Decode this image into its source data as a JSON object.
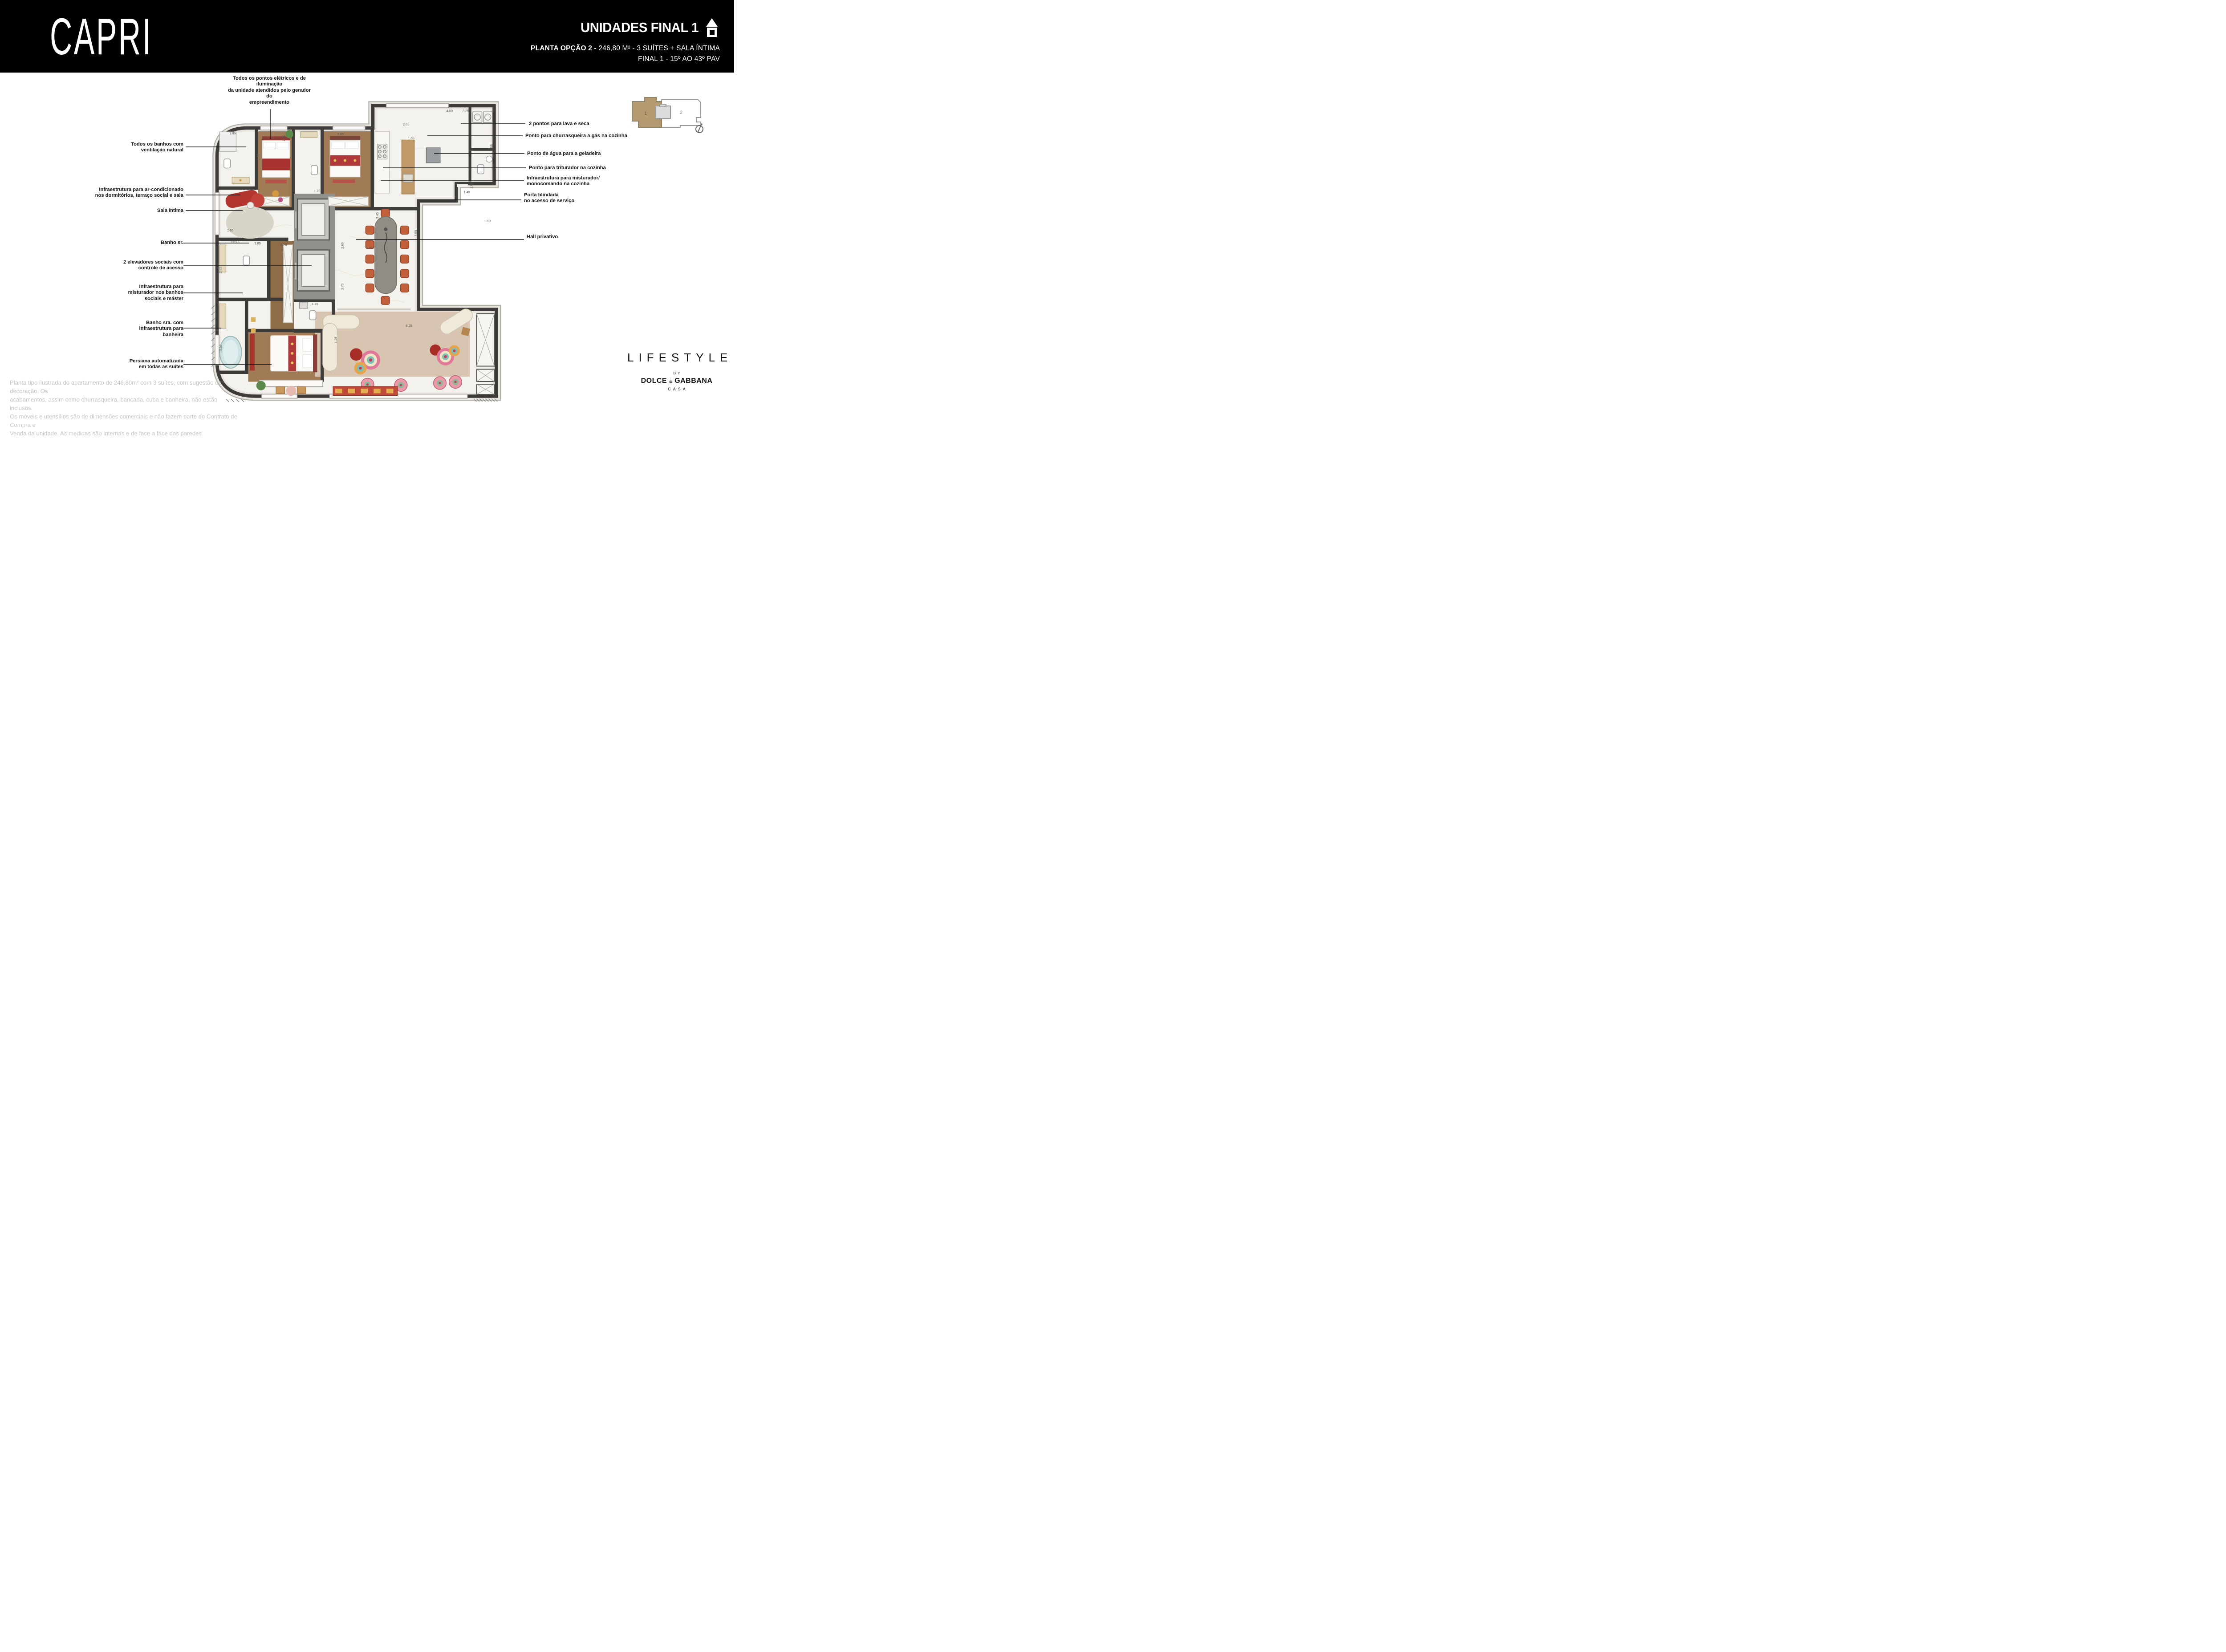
{
  "header": {
    "brand": "CAPRI",
    "units_title": "UNIDADES FINAL 1",
    "plan_option_bold": "PLANTA OPÇÃO 2 - ",
    "plan_option_rest": "246,80 M² - 3 SUÍTES + SALA ÍNTIMA",
    "floors_line": "FINAL 1 - 15º AO 43º PAV"
  },
  "key_plan": {
    "unit_1": "1",
    "unit_2": "2"
  },
  "callouts_left": [
    {
      "label": "Todos os pontos elétricos e de\niluminação\nda unidade atendidos pelo gerador\ndo\nempreendimento"
    },
    {
      "label": "Todos os banhos com\nventilação natural"
    },
    {
      "label": "Infraestrutura para ar-condicionado\nnos dormitórios, terraço social e sala"
    },
    {
      "label": "Sala íntima"
    },
    {
      "label": "Banho sr."
    },
    {
      "label": "2 elevadores sociais com\ncontrole de acesso"
    },
    {
      "label": "Infraestrutura para\nmisturador nos banhos\nsociais e máster"
    },
    {
      "label": "Banho sra. com\ninfraestrutura para\nbanheira"
    },
    {
      "label": "Persiana automatizada\nem todas as suítes"
    }
  ],
  "callouts_right": [
    {
      "label": "2 pontos para lava e seca"
    },
    {
      "label": "Ponto para churrasqueira a gás na cozinha"
    },
    {
      "label": "Ponto de água para a geladeira"
    },
    {
      "label": "Ponto para triturador na cozinha"
    },
    {
      "label": "Infraestrutura para misturador/\nmonocomando na cozinha"
    },
    {
      "label": "Porta blindada\nno acesso de serviço"
    },
    {
      "label": "Hall privativo"
    }
  ],
  "plan": {
    "dims": [
      {
        "t": "1.85"
      },
      {
        "t": "2.35"
      },
      {
        "t": "2.40"
      },
      {
        "t": "2.80"
      },
      {
        "t": "1.70"
      },
      {
        "t": "1.65"
      },
      {
        "t": "12.25"
      },
      {
        "t": "4.00"
      },
      {
        "t": "2.25"
      },
      {
        "t": "2.05"
      },
      {
        "t": "1.55"
      },
      {
        "t": "3.45"
      },
      {
        "t": "1.45"
      },
      {
        "t": "1.10"
      },
      {
        "t": "1.95"
      },
      {
        "t": "2.55"
      },
      {
        "t": "4.20"
      },
      {
        "t": "1.50"
      },
      {
        "t": "3.70"
      },
      {
        "t": "2.60"
      },
      {
        "t": "1.75"
      },
      {
        "t": "1.25"
      },
      {
        "t": "2.45"
      },
      {
        "t": "8.25"
      },
      {
        "t": "7.55"
      },
      {
        "t": "1.85"
      },
      {
        "t": "3.50"
      }
    ]
  },
  "disclaimer": {
    "text": "Planta tipo ilustrada do apartamento de 246,80m² com 3 suítes, com sugestão de decoração. Os\nacabamentos, assim como churrasqueira, bancada, cuba e banheira, não estão inclusos.\nOs móveis e utensílios são de dimensões comerciais e não fazem parte do Contrato de Compra e\nVenda da unidade. As medidas são internas e de face a face das paredes."
  },
  "logo": {
    "lifestyle": "LIFESTYLE",
    "by": "BY",
    "dolce": "DOLCE",
    "amp": "&",
    "gabbana": "GABBANA",
    "casa": "CASA"
  },
  "colors": {
    "header_bg": "#000000",
    "wall": "#3d3c3a",
    "accent_red": "#a8332e",
    "keyplan_unit": "#b49a71"
  }
}
